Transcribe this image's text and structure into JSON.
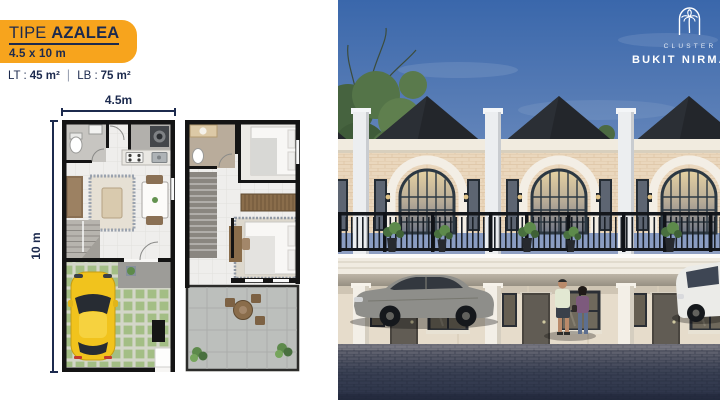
{
  "left_panel": {
    "badge": {
      "prefix": "TIPE",
      "name": "AZALEA",
      "size": "4.5 x 10 m"
    },
    "areas": {
      "lt_label": "LT :",
      "lt_value": "45 m²",
      "separator": "|",
      "lb_label": "LB :",
      "lb_value": "75 m²"
    },
    "floorplan": {
      "width_label": "4.5m",
      "height_label": "10 m"
    }
  },
  "render": {
    "logo": {
      "cluster_label": "CLUSTER",
      "name": "BUKIT NIRMALA",
      "icon": "arch-palm-icon"
    }
  },
  "colors": {
    "badge_orange": "#F7A41D",
    "navy_text": "#1C2A4E",
    "sky_top": "#3A67AB",
    "facade_cream": "#EAD7BD",
    "roof_dark": "#23262B",
    "railing_dark": "#14171C",
    "pavement_dark": "#2E3548",
    "grass_green": "#A3BE85",
    "car_yellow": "#F1C31D"
  }
}
